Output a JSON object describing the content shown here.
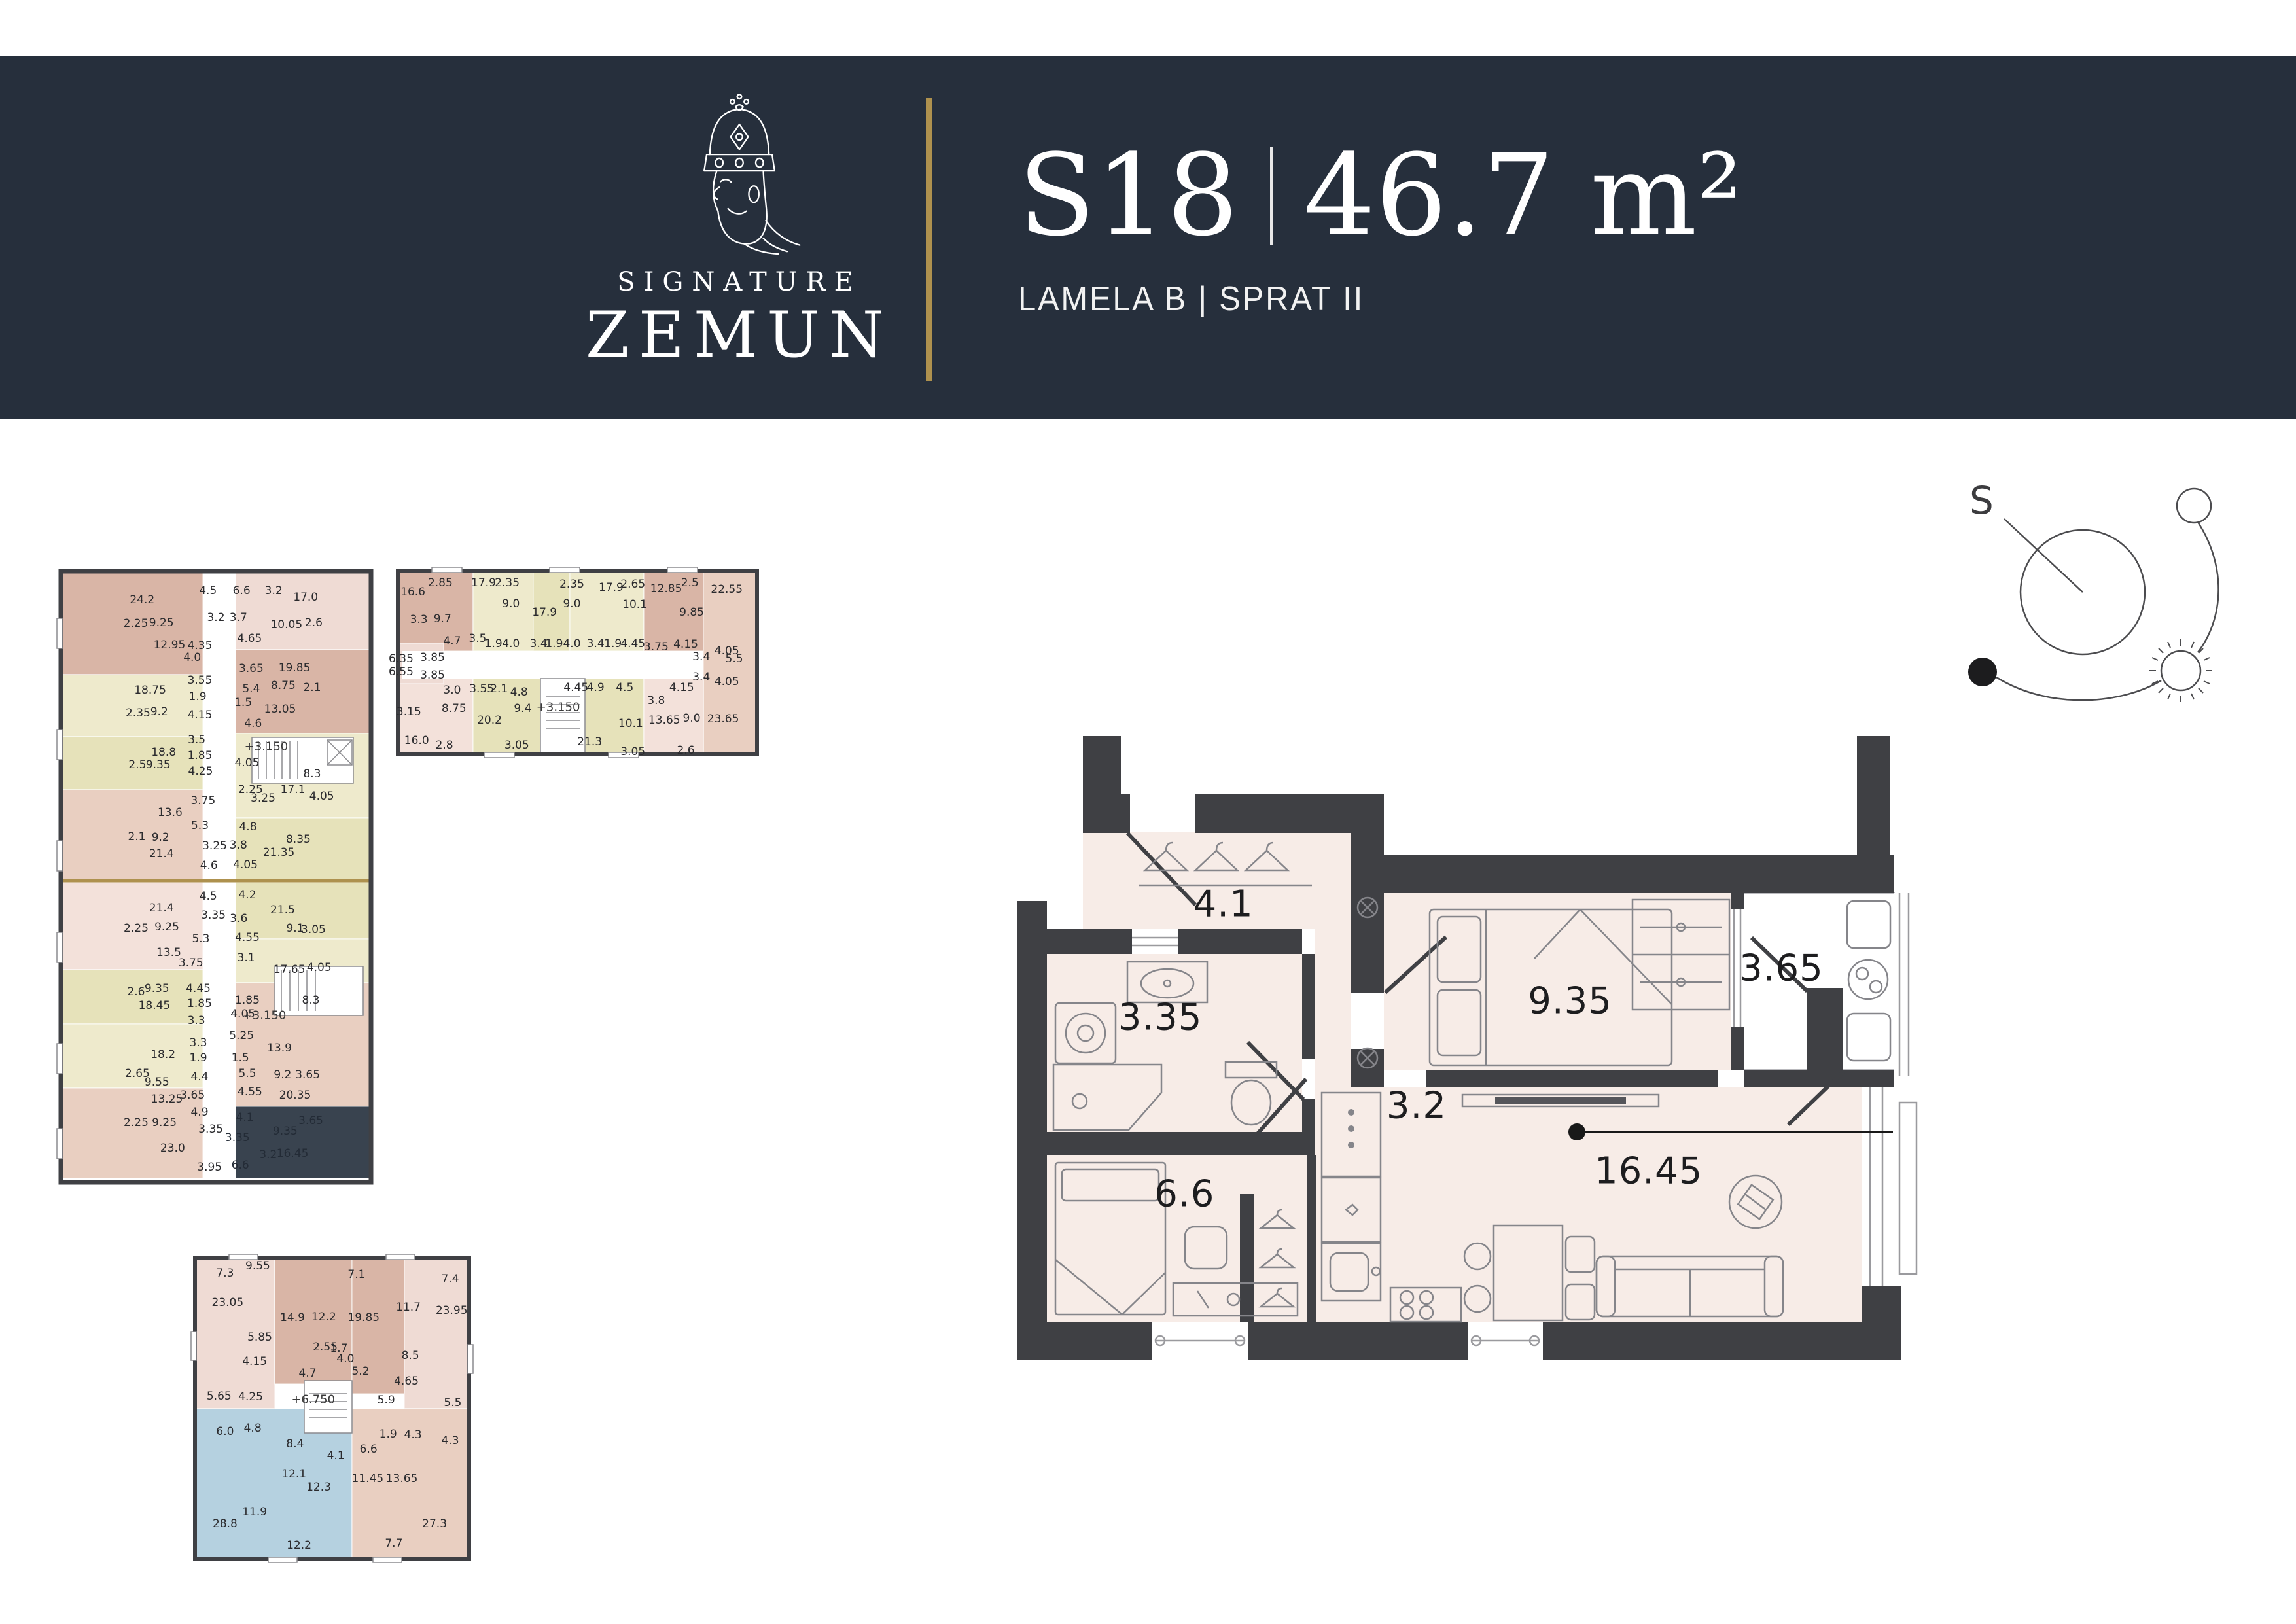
{
  "palette": {
    "header": "#262f3c",
    "gold": "#ae914e",
    "wall": "#3f4044",
    "floor": "#f7ece7",
    "highlight_dark": "#39434f",
    "highlight_blue": "#b5d1e0",
    "tan": "#d9b5a6",
    "cream": "#eeeacc",
    "pink": "#f3e1da"
  },
  "header": {
    "brand_top": "SIGNATURE",
    "brand_bottom": "ZEMUN",
    "unit_id": "S18",
    "unit_area": "46.7 m²",
    "subtitle": "LAMELA B | SPRAT II"
  },
  "compass": {
    "south_label": "S"
  },
  "main_plan": {
    "rooms": [
      [
        "4.1",
        22.8,
        26.8
      ],
      [
        "3.35",
        15.8,
        44.8
      ],
      [
        "9.35",
        61.2,
        42.2
      ],
      [
        "3.65",
        84.6,
        37.0
      ],
      [
        "6.6",
        18.5,
        72.9
      ],
      [
        "3.2",
        44.2,
        58.9
      ],
      [
        "16.45",
        69.9,
        69.3
      ]
    ]
  },
  "key_plan_1": {
    "labels": [
      [
        "24.2",
        27,
        5.5
      ],
      [
        "4.5",
        47.5,
        4
      ],
      [
        "6.6",
        58,
        4
      ],
      [
        "3.2",
        68,
        4
      ],
      [
        "17.0",
        78,
        5
      ],
      [
        "2.25",
        25,
        9.3
      ],
      [
        "9.25",
        33,
        9.2
      ],
      [
        "3.2",
        50,
        8.3
      ],
      [
        "3.7",
        57,
        8.3
      ],
      [
        "10.05",
        72,
        9.5
      ],
      [
        "2.6",
        80.5,
        9.2
      ],
      [
        "12.95",
        35.5,
        12.7
      ],
      [
        "4.35",
        45,
        12.8
      ],
      [
        "4.0",
        42.6,
        14.7
      ],
      [
        "4.65",
        60.5,
        11.7
      ],
      [
        "19.85",
        74.5,
        16.4
      ],
      [
        "3.65",
        61,
        16.5
      ],
      [
        "18.75",
        29.5,
        20
      ],
      [
        "3.55",
        45,
        18.4
      ],
      [
        "5.4",
        61,
        19.8
      ],
      [
        "8.75",
        71,
        19.3
      ],
      [
        "2.1",
        80,
        19.6
      ],
      [
        "1.9",
        44.3,
        21
      ],
      [
        "2.35",
        25.7,
        23.7
      ],
      [
        "9.2",
        32.3,
        23.5
      ],
      [
        "4.15",
        45,
        24
      ],
      [
        "13.05",
        70,
        23
      ],
      [
        "1.5",
        58.5,
        22
      ],
      [
        "4.6",
        61.6,
        25.4
      ],
      [
        "18.8",
        33.7,
        30
      ],
      [
        "3.5",
        44,
        28
      ],
      [
        "1.85",
        45,
        30.5
      ],
      [
        "2.5",
        25.5,
        32
      ],
      [
        "9.35",
        32,
        32
      ],
      [
        "4.25",
        45.2,
        33
      ],
      [
        "+3.150",
        65.7,
        29,
        "lvl"
      ],
      [
        "4.05",
        59.7,
        31.7
      ],
      [
        "8.3",
        80,
        33.5
      ],
      [
        "2.25",
        60.8,
        36
      ],
      [
        "17.1",
        74,
        36
      ],
      [
        "4.05",
        83,
        37
      ],
      [
        "3.25",
        64.7,
        37.4
      ],
      [
        "13.6",
        35.7,
        39.7
      ],
      [
        "3.75",
        46,
        37.8
      ],
      [
        "5.3",
        45,
        41.8
      ],
      [
        "2.1",
        25.3,
        43.6
      ],
      [
        "9.2",
        32.7,
        43.7
      ],
      [
        "4.8",
        60,
        42
      ],
      [
        "8.35",
        75.7,
        44
      ],
      [
        "21.4",
        33,
        46.3
      ],
      [
        "3.25",
        49.6,
        45
      ],
      [
        "3.8",
        57,
        44.9
      ],
      [
        "21.35",
        69.6,
        46.1
      ],
      [
        "4.6",
        47.8,
        48.2
      ],
      [
        "4.05",
        59.2,
        48.1
      ],
      [
        "4.5",
        47.6,
        53.2
      ],
      [
        "21.4",
        33,
        55
      ],
      [
        "4.2",
        59.8,
        52.9
      ],
      [
        "21.5",
        70.8,
        55.4
      ],
      [
        "3.35",
        49.2,
        56.2
      ],
      [
        "3.6",
        57.1,
        56.7
      ],
      [
        "2.25",
        25.1,
        58.3
      ],
      [
        "9.25",
        34.7,
        58.1
      ],
      [
        "9.1",
        74.7,
        58.3
      ],
      [
        "3.05",
        80.4,
        58.5
      ],
      [
        "5.3",
        45.3,
        60
      ],
      [
        "4.55",
        59.8,
        59.8
      ],
      [
        "13.5",
        35.3,
        62.2
      ],
      [
        "3.75",
        42.2,
        63.9
      ],
      [
        "3.1",
        59.4,
        63
      ],
      [
        "17.65",
        72.9,
        64.9
      ],
      [
        "4.05",
        82.2,
        64.6
      ],
      [
        "2.6",
        25.1,
        68.5
      ],
      [
        "9.35",
        31.6,
        68
      ],
      [
        "4.45",
        44.5,
        68
      ],
      [
        "1.85",
        59.8,
        69.9
      ],
      [
        "8.3",
        79.6,
        69.9
      ],
      [
        "18.45",
        30.8,
        70.7
      ],
      [
        "1.85",
        44.9,
        70.4
      ],
      [
        "4.05",
        58.4,
        72.1
      ],
      [
        "3.3",
        43.9,
        73.2
      ],
      [
        "+3.150",
        65.1,
        72.3,
        "lvl"
      ],
      [
        "18.2",
        33.5,
        78.6
      ],
      [
        "3.3",
        44.5,
        76.7
      ],
      [
        "1.9",
        44.5,
        79.2
      ],
      [
        "5.25",
        58,
        75.6
      ],
      [
        "13.9",
        69.8,
        77.6
      ],
      [
        "2.65",
        25.5,
        81.7
      ],
      [
        "9.55",
        31.6,
        83
      ],
      [
        "4.4",
        44.9,
        82.2
      ],
      [
        "1.5",
        57.6,
        79.2
      ],
      [
        "5.5",
        59.8,
        81.7
      ],
      [
        "9.2",
        70.8,
        81.9
      ],
      [
        "3.65",
        78.6,
        81.9
      ],
      [
        "13.25",
        34.7,
        85.8
      ],
      [
        "3.65",
        42.7,
        85.2
      ],
      [
        "4.55",
        60.6,
        84.6
      ],
      [
        "20.35",
        74.7,
        85.2
      ],
      [
        "4.9",
        44.9,
        87.9
      ],
      [
        "2.25",
        25.1,
        89.6
      ],
      [
        "9.25",
        33.9,
        89.6
      ],
      [
        "3.35",
        48.4,
        90.6
      ],
      [
        "23.0",
        36.5,
        93.7
      ],
      [
        "3.95",
        48,
        96.7
      ],
      [
        "4.1",
        59,
        88.7,
        "d"
      ],
      [
        "9.35",
        71.6,
        90.9,
        "d"
      ],
      [
        "3.65",
        79.6,
        89.3,
        "d"
      ],
      [
        "3.35",
        56.7,
        92,
        "d"
      ],
      [
        "3.2",
        66.3,
        94.7,
        "d"
      ],
      [
        "6.6",
        57.6,
        96.4,
        "d"
      ],
      [
        "16.45",
        73.9,
        94.5,
        "d"
      ]
    ]
  },
  "key_plan_2": {
    "labels": [
      [
        "16.6",
        5.5,
        13.6
      ],
      [
        "2.85",
        12.9,
        8.8
      ],
      [
        "17.9",
        24.6,
        8.8
      ],
      [
        "2.35",
        31,
        8.8
      ],
      [
        "2.35",
        48.5,
        9.5
      ],
      [
        "17.9",
        59.1,
        11.2
      ],
      [
        "2.65",
        65,
        9.5
      ],
      [
        "12.85",
        74,
        11.9
      ],
      [
        "2.5",
        80.4,
        8.8
      ],
      [
        "22.55",
        90.4,
        12.2
      ],
      [
        "9.0",
        32,
        19.7
      ],
      [
        "17.9",
        41.1,
        24.1
      ],
      [
        "9.0",
        48.5,
        19.7
      ],
      [
        "10.1",
        65.5,
        20
      ],
      [
        "9.85",
        80.9,
        24.1
      ],
      [
        "3.3",
        7.1,
        27.8
      ],
      [
        "9.7",
        13.5,
        27.5
      ],
      [
        "4.7",
        16.1,
        39
      ],
      [
        "3.5",
        23,
        37.6
      ],
      [
        "1.9",
        27.3,
        40.3
      ],
      [
        "4.0",
        32,
        40.3
      ],
      [
        "3.4",
        39.5,
        40.3
      ],
      [
        "1.9",
        43.7,
        40.3
      ],
      [
        "4.0",
        48.5,
        40.3
      ],
      [
        "3.4",
        54.9,
        40.3
      ],
      [
        "1.9",
        59.6,
        40.3
      ],
      [
        "4.45",
        65,
        40.3
      ],
      [
        "3.75",
        71.3,
        42
      ],
      [
        "4.15",
        79.3,
        40.7
      ],
      [
        "4.05",
        90.4,
        44.1
      ],
      [
        "3.4",
        83.5,
        47.1
      ],
      [
        "6.35",
        2.3,
        48.1
      ],
      [
        "3.85",
        10.8,
        47.5
      ],
      [
        "6.55",
        2.3,
        54.9
      ],
      [
        "3.85",
        10.8,
        56.6
      ],
      [
        "3.4",
        83.5,
        57.6
      ],
      [
        "4.05",
        90.4,
        60
      ],
      [
        "3.0",
        16.1,
        64.4
      ],
      [
        "3.55",
        24.1,
        63.7
      ],
      [
        "2.1",
        28.8,
        63.7
      ],
      [
        "4.8",
        34.2,
        65.4
      ],
      [
        "4.45",
        49.6,
        63.1
      ],
      [
        "4.9",
        54.9,
        63.1
      ],
      [
        "4.5",
        62.8,
        63.1
      ],
      [
        "4.15",
        78.2,
        63.1
      ],
      [
        "8.75",
        16.6,
        73.9
      ],
      [
        "9.4",
        35.2,
        73.9
      ],
      [
        "+3.150",
        44.8,
        73.2,
        "lvl"
      ],
      [
        "3.8",
        71.3,
        69.8
      ],
      [
        "3.15",
        4.4,
        75.6
      ],
      [
        "20.2",
        26.2,
        80
      ],
      [
        "10.1",
        64.4,
        81.7
      ],
      [
        "13.65",
        73.5,
        80
      ],
      [
        "9.0",
        80.9,
        79
      ],
      [
        "23.65",
        89.4,
        79.3
      ],
      [
        "16.0",
        6.5,
        90.5
      ],
      [
        "2.8",
        14,
        92.9
      ],
      [
        "3.05",
        33.6,
        92.9
      ],
      [
        "21.3",
        53.3,
        91.2
      ],
      [
        "3.05",
        65,
        96.3
      ],
      [
        "2.6",
        79.3,
        95.6
      ],
      [
        "5.5",
        92.4,
        48.2
      ]
    ]
  },
  "key_plan_3": {
    "labels": [
      [
        "7.3",
        12.4,
        6.5
      ],
      [
        "9.55",
        23.9,
        4.2
      ],
      [
        "7.1",
        58.6,
        6.9
      ],
      [
        "7.4",
        91.5,
        8.4
      ],
      [
        "23.05",
        13.3,
        16
      ],
      [
        "14.9",
        36.1,
        20.8
      ],
      [
        "12.2",
        47.1,
        20.6
      ],
      [
        "19.85",
        61.1,
        20.8
      ],
      [
        "11.7",
        76.8,
        17.5
      ],
      [
        "23.95",
        92,
        18.5
      ],
      [
        "5.85",
        24.6,
        27.2
      ],
      [
        "2.55",
        47.6,
        30.3
      ],
      [
        "1.7",
        52.4,
        30.7
      ],
      [
        "4.0",
        54.7,
        34.1
      ],
      [
        "5.2",
        60,
        38.1
      ],
      [
        "8.5",
        77.5,
        33.1
      ],
      [
        "4.15",
        22.8,
        34.9
      ],
      [
        "4.7",
        41.4,
        38.7
      ],
      [
        "4.65",
        76.1,
        41.3
      ],
      [
        "4.25",
        21.4,
        46.3
      ],
      [
        "5.65",
        10.3,
        46.1
      ],
      [
        "+6.750",
        43.4,
        47.2,
        "lvl"
      ],
      [
        "5.9",
        69,
        47.4
      ],
      [
        "5.5",
        92.4,
        48.2
      ],
      [
        "6.0",
        12.4,
        57.5
      ],
      [
        "4.8",
        22.1,
        56.4
      ],
      [
        "8.4",
        37,
        61.5
      ],
      [
        "4.1",
        51.3,
        65.3
      ],
      [
        "1.9",
        69.7,
        58.3
      ],
      [
        "4.3",
        78.4,
        58.6
      ],
      [
        "4.3",
        91.5,
        60.4
      ],
      [
        "6.6",
        62.8,
        63.2
      ],
      [
        "12.1",
        36.6,
        71.2
      ],
      [
        "12.3",
        45.3,
        75.4
      ],
      [
        "11.45",
        62.5,
        72.6
      ],
      [
        "13.65",
        74.5,
        72.6
      ],
      [
        "11.9",
        22.8,
        83.4
      ],
      [
        "28.8",
        12.4,
        87.2
      ],
      [
        "27.3",
        86,
        87.2
      ],
      [
        "12.2",
        38.4,
        94.1
      ],
      [
        "7.7",
        71.7,
        93.5
      ]
    ]
  }
}
